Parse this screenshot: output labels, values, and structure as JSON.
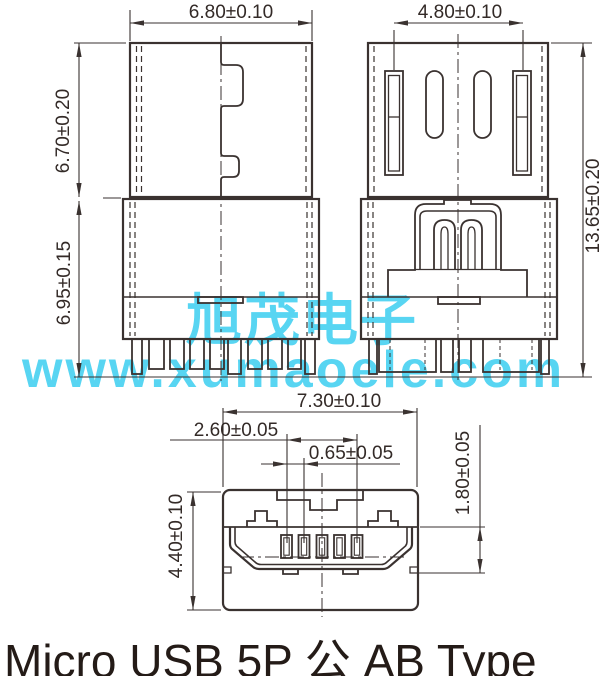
{
  "title": "Micro USB  5P 公 AB Type",
  "watermark": {
    "line1": "旭茂电子",
    "line2": "www.xumaoele.com",
    "color": "#58d5f2"
  },
  "dimensions": {
    "shell_width": "6.80±0.10",
    "slot_spacing": "4.80±0.10",
    "shell_height": "6.70±0.20",
    "body_height": "6.95±0.15",
    "total_height": "13.65±0.20",
    "face_width": "7.30±0.10",
    "pin_span": "2.60±0.05",
    "pin_pitch": "0.65±0.05",
    "face_height": "4.40±0.10",
    "opening_height": "1.80±0.05"
  },
  "colors": {
    "line": "#3a3230",
    "text": "#332a27",
    "title_text": "#241b17",
    "watermark": "#58d5f2",
    "background": "#ffffff"
  }
}
